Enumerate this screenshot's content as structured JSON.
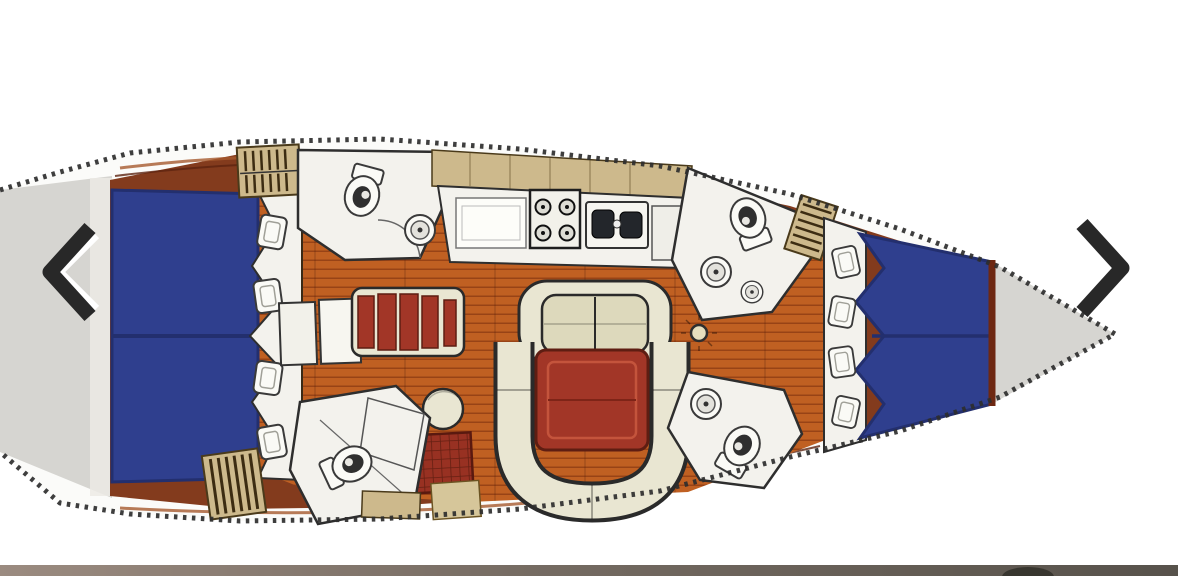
{
  "viewer": {
    "prev_button": {
      "icon": "chevron-left-icon",
      "aria_label": "Previous image"
    },
    "next_button": {
      "icon": "chevron-right-icon",
      "aria_label": "Next image"
    },
    "next_image_strip_visible": true
  },
  "floorplan": {
    "subject": "sailboat-interior-deck-plan-top-view-bow-right",
    "regions": [
      "stern-deck",
      "aft-double-berth-port",
      "aft-double-berth-starboard",
      "berth-pillows",
      "companionway-steps",
      "aft-head-top",
      "aft-head-bottom",
      "galley-counter",
      "stove-4-burner",
      "double-sink",
      "nav-station",
      "sideboard-red-slats",
      "footstool",
      "dinette-bench",
      "dinette-table",
      "saloon-u-settee",
      "saloon-table",
      "floor-locker-grate",
      "mast-post",
      "forward-head",
      "forward-v-berth",
      "foredeck",
      "toe-rail-serrated"
    ],
    "visible_berths": 3,
    "visible_heads": 3
  },
  "colors": {
    "hull_fill": "#fbfbf9",
    "deck_gray": "#d6d5d1",
    "trim_wood": "#833b1d",
    "trim_streak": "#a65a2e",
    "trim_streak_dark": "#5e2410",
    "floor_base": "#c06022",
    "floor_line": "#8f3c12",
    "berth_blue": "#2f3f8e",
    "berth_blue_dark": "#232f6e",
    "pillow_white": "#fafaf6",
    "room_white": "#f3f2ed",
    "outline_dark": "#2e2e2e",
    "beige": "#cdb98c",
    "beige_slat": "#3c2c12",
    "cream": "#e9e6d2",
    "table_red": "#a23627",
    "table_red_dark": "#5e1d12",
    "locker_red": "#983122",
    "arrow_dark": "#282828",
    "arrow_highlight": "#ffffff",
    "bar_from": "#9b8b80",
    "bar_mid": "#756b62",
    "bar_to": "#57524b",
    "bar_blob": "#38362f"
  }
}
